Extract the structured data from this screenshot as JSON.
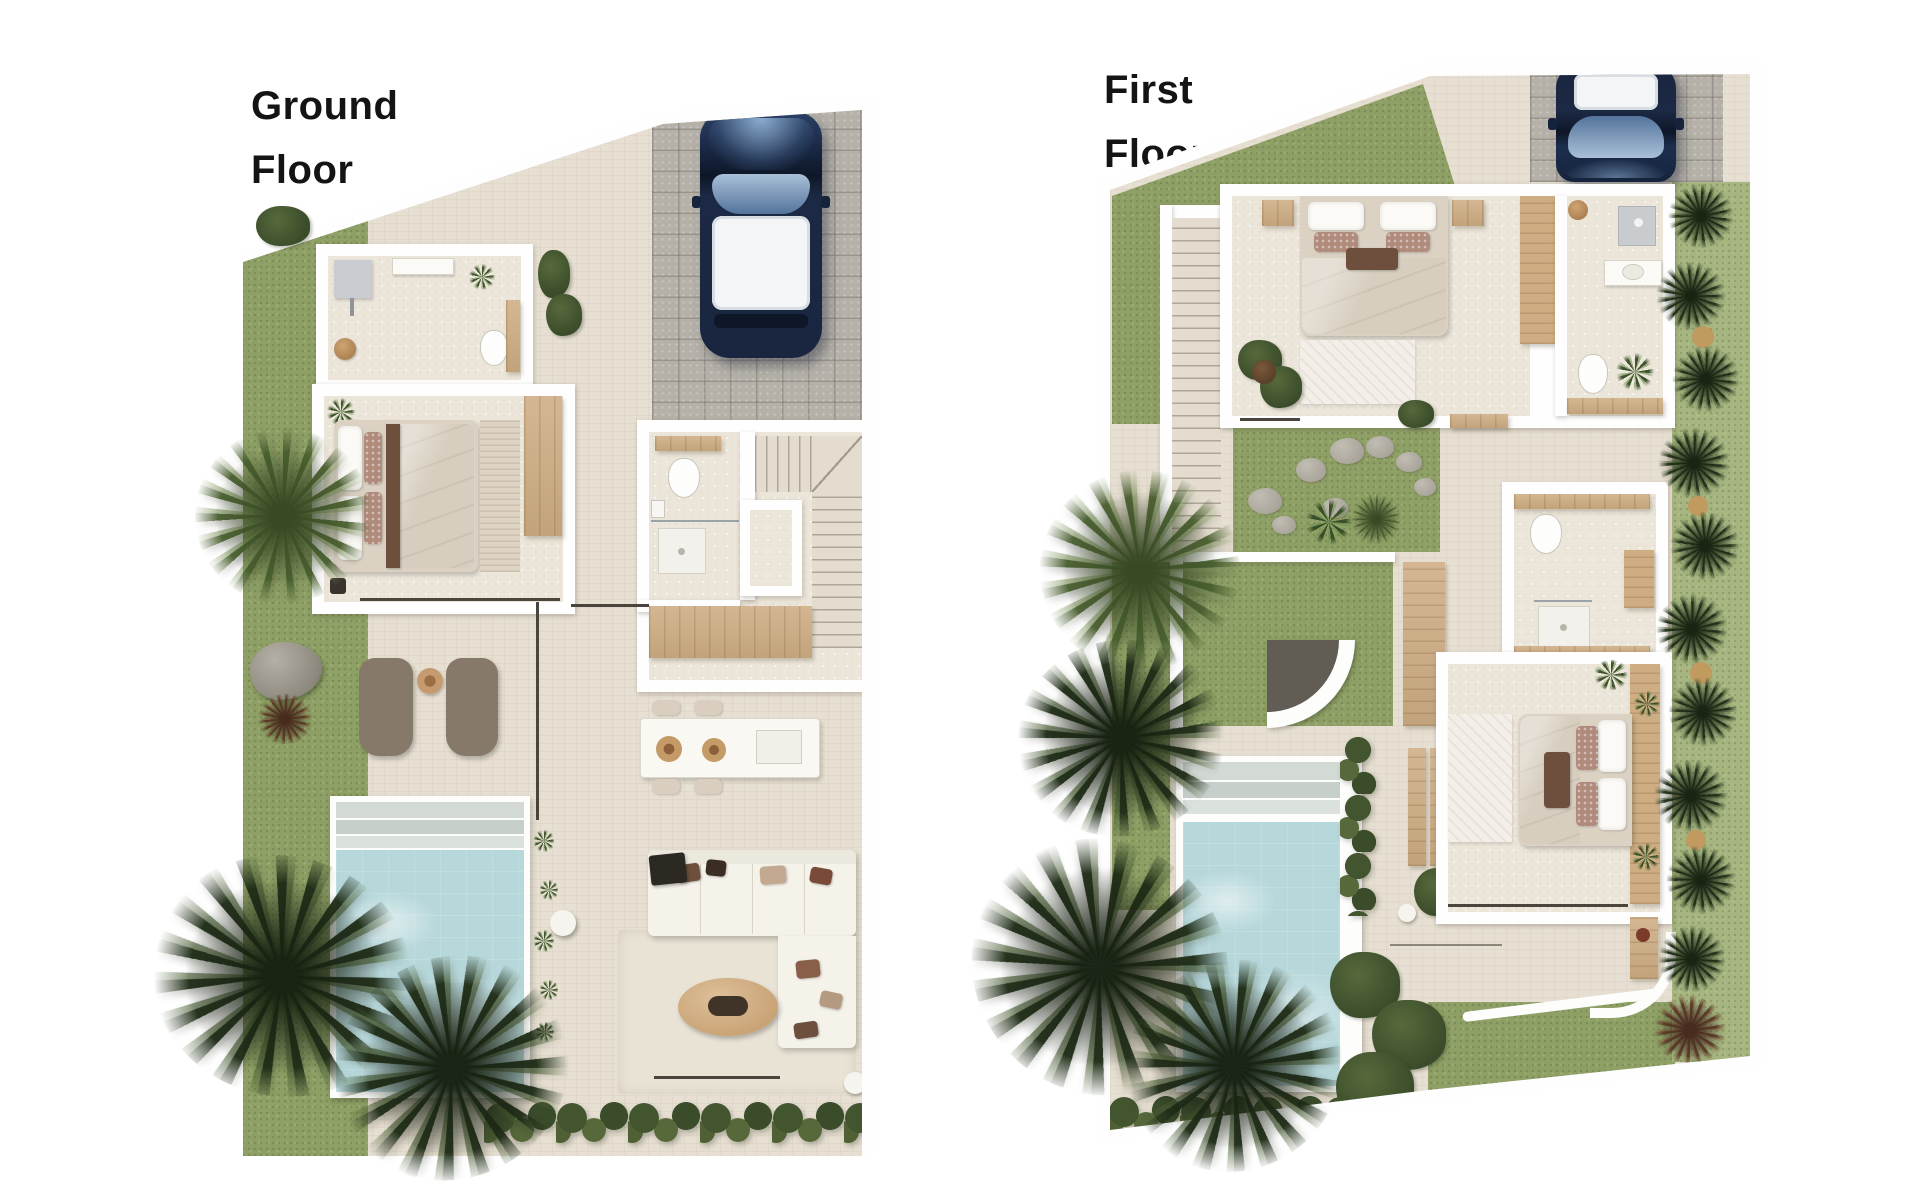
{
  "canvas": {
    "width": 1920,
    "height": 1200,
    "background": "#ffffff"
  },
  "plans": [
    {
      "id": "ground-floor",
      "title_lines": [
        "Ground",
        "Floor"
      ]
    },
    {
      "id": "first-floor",
      "title_lines": [
        "First",
        "Floor"
      ]
    }
  ],
  "palette": {
    "title_color": "#141414",
    "travertine": "#e7e0d2",
    "travertine_light": "#ece6da",
    "grass": "#8ea065",
    "grass_light": "#a7b680",
    "paver": "#b5b1a9",
    "pool_water": "#b7d8db",
    "pool_step": "#ccd4d0",
    "wood": "#cead83",
    "wall": "#fefefe",
    "hedge_dark": "#3a4c2a",
    "hedge_mid": "#57693b",
    "car_body": "#1c2944",
    "car_glass": "#9db6cf",
    "car_roof": "#f3f5f6",
    "lounger": "#87796a",
    "sofa": "#f5f2ea",
    "cushion_brown": "#6e4f3d",
    "accent_rosy": "#b08b7c"
  }
}
